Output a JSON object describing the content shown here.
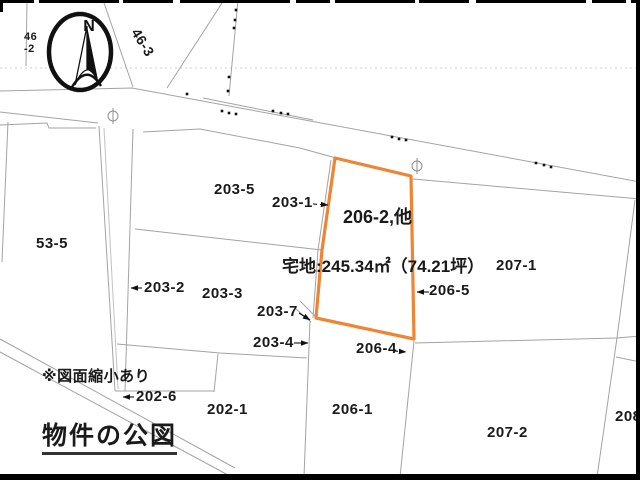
{
  "title": "物件の公図",
  "note": "※図面縮小あり",
  "compass": {
    "north_label": "N"
  },
  "highlight": {
    "parcel_label": "206-2,他",
    "area_label": "宅地:245.34㎡（74.21坪）",
    "outline_color": "#ef8433"
  },
  "colors": {
    "boundary_line": "#a3a3a3",
    "text": "#1a1a1a"
  },
  "parcels": {
    "p46_2": "46\n-2",
    "p46_3": "46-3",
    "p53_5": "53-5",
    "p202_1": "202-1",
    "p202_6": "202-6",
    "p203_1": "203-1",
    "p203_2": "203-2",
    "p203_3": "203-3",
    "p203_4": "203-4",
    "p203_5": "203-5",
    "p203_7": "203-7",
    "p206_1": "206-1",
    "p206_4": "206-4",
    "p206_5": "206-5",
    "p207_1": "207-1",
    "p207_2": "207-2",
    "p208": "208"
  }
}
